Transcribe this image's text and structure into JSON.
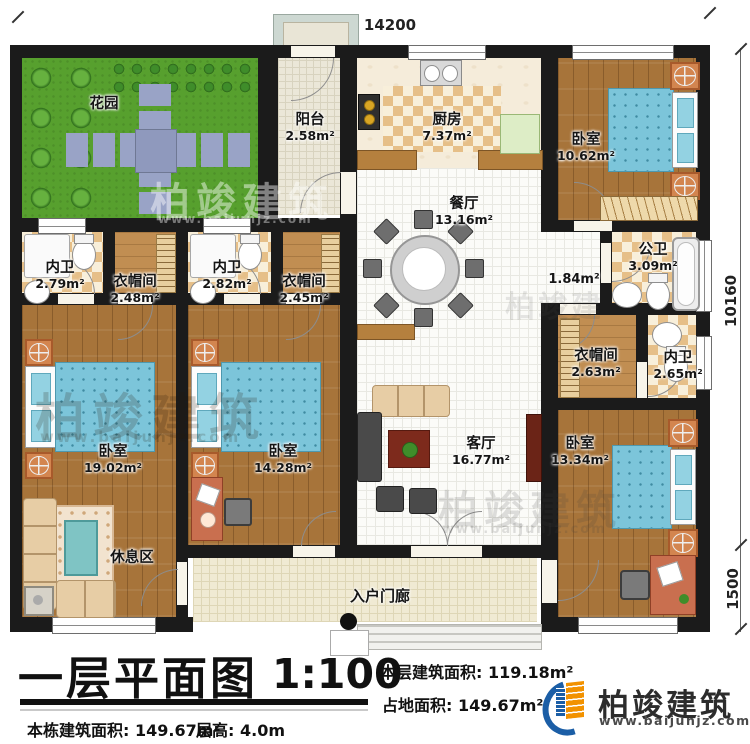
{
  "plan": {
    "dimensions": {
      "width": "14200",
      "height_main": "10160",
      "height_porch": "1500"
    },
    "rooms": {
      "garden": {
        "name": "花园"
      },
      "balcony": {
        "name": "阳台",
        "area": "2.58m²"
      },
      "kitchen": {
        "name": "厨房",
        "area": "7.37m²"
      },
      "bedroom_top_right": {
        "name": "卧室",
        "area": "10.62m²"
      },
      "dining": {
        "name": "餐厅",
        "area": "13.16m²"
      },
      "bath_suite1": {
        "name": "内卫",
        "area": "2.79m²"
      },
      "closet_suite1": {
        "name": "衣帽间",
        "area": "2.48m²"
      },
      "bath_suite2": {
        "name": "内卫",
        "area": "2.82m²"
      },
      "closet_suite2": {
        "name": "衣帽间",
        "area": "2.45m²"
      },
      "public_bath": {
        "name": "公卫",
        "area": "3.09m²"
      },
      "hallway": {
        "area": "1.84m²"
      },
      "closet_right": {
        "name": "衣帽间",
        "area": "2.63m²"
      },
      "bath_right": {
        "name": "内卫",
        "area": "2.65m²"
      },
      "bedroom_bottom_left": {
        "name": "卧室",
        "area": "19.02m²"
      },
      "rest_area": {
        "name": "休息区"
      },
      "bedroom_bottom_mid": {
        "name": "卧室",
        "area": "14.28m²"
      },
      "living": {
        "name": "客厅",
        "area": "16.77m²"
      },
      "bedroom_bottom_right": {
        "name": "卧室",
        "area": "13.34m²"
      },
      "porch": {
        "name": "入户门廊"
      }
    }
  },
  "title_block": {
    "title": "一层平面图",
    "scale": "1:100",
    "floor_area_label": "本层建筑面积:",
    "floor_area_value": "119.18m²",
    "land_area_label": "占地面积:",
    "land_area_value": "149.67m²",
    "total_area_label": "本栋建筑面积:",
    "total_area_value": "149.67m²",
    "floor_height_label": "层高:",
    "floor_height_value": "4.0m"
  },
  "branding": {
    "company": "柏竣建筑",
    "website": "www.baijunjz.com"
  },
  "watermark": {
    "text": "柏竣建筑",
    "url": "www.baijunjz.com"
  },
  "colors": {
    "accent_blue": "#1b5ea6",
    "accent_orange": "#f29200",
    "wall": "#1b1b1b"
  }
}
